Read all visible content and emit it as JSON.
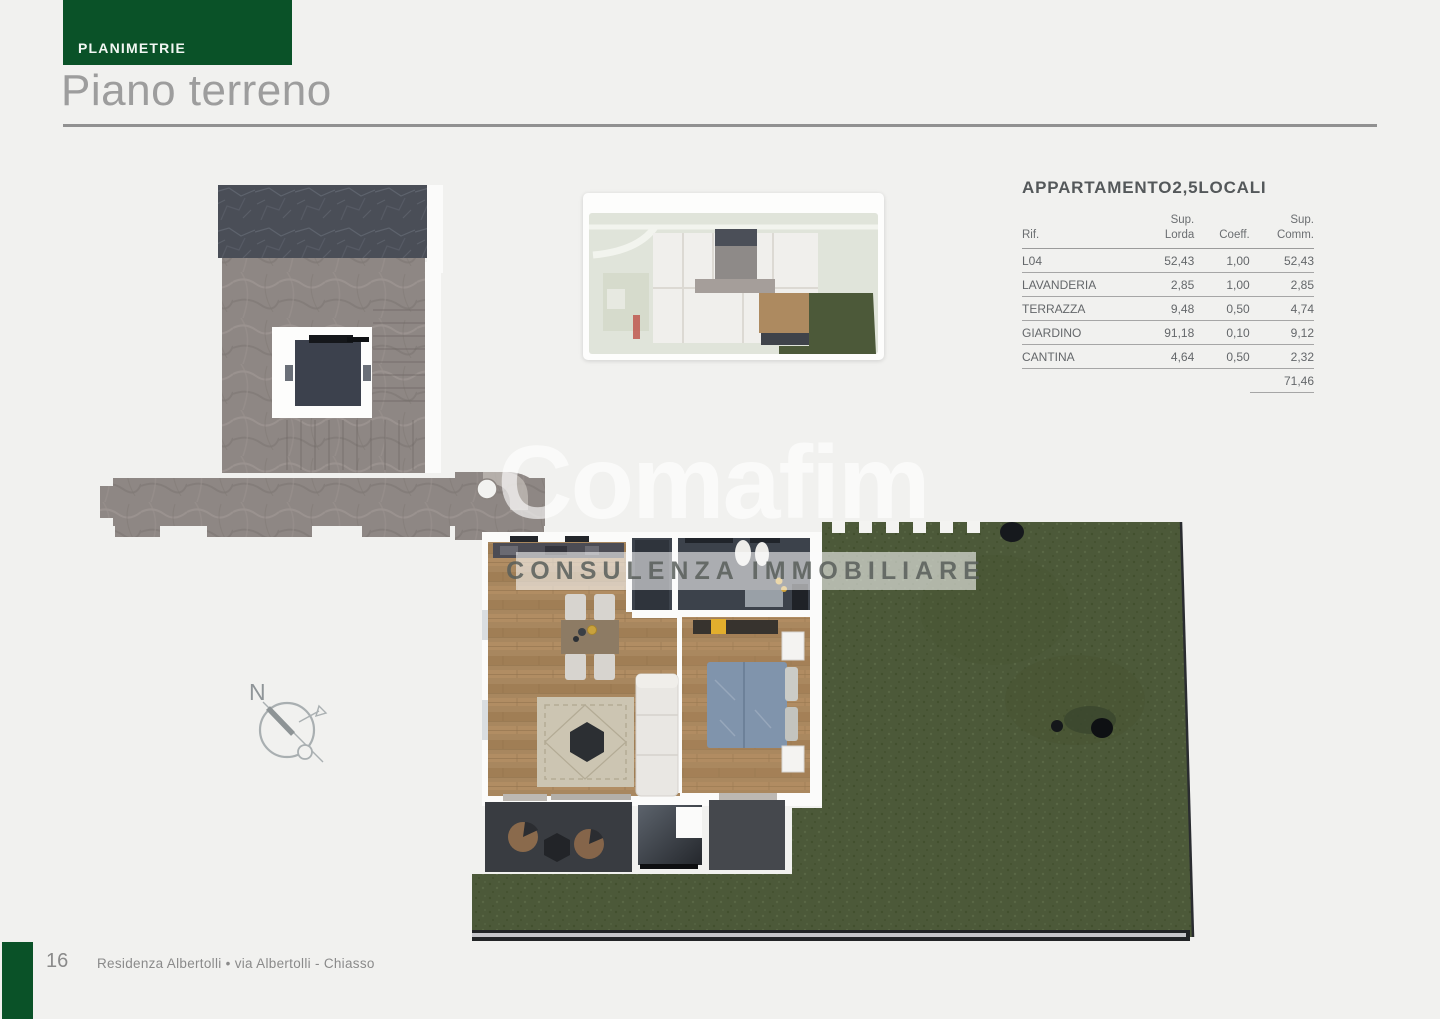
{
  "header": {
    "tag": "PLANIMETRIE",
    "title": "Piano terreno"
  },
  "apartment_panel": {
    "title": "APPARTAMENTO2,5LOCALI",
    "columns": [
      {
        "label": "Rif."
      },
      {
        "label": "Sup.\nLorda"
      },
      {
        "label": "Coeff."
      },
      {
        "label": "Sup.\nComm."
      }
    ],
    "rows": [
      {
        "rif": "L04",
        "lorda": "52,43",
        "coeff": "1,00",
        "comm": "52,43"
      },
      {
        "rif": "LAVANDERIA",
        "lorda": "2,85",
        "coeff": "1,00",
        "comm": "2,85"
      },
      {
        "rif": "TERRAZZA",
        "lorda": "9,48",
        "coeff": "0,50",
        "comm": "4,74"
      },
      {
        "rif": "GIARDINO",
        "lorda": "91,18",
        "coeff": "0,10",
        "comm": "9,12"
      },
      {
        "rif": "CANTINA",
        "lorda": "4,64",
        "coeff": "0,50",
        "comm": "2,32"
      }
    ],
    "total": "71,46"
  },
  "watermark": {
    "brand": "Comafim",
    "tagline": "CONSULENZA IMMOBILIARE"
  },
  "compass": {
    "north": "N"
  },
  "footer": {
    "page_number": "16",
    "project": "Residenza Albertolli • via Albertolli - Chiasso"
  },
  "colors": {
    "accent_green": "#0a5228",
    "garden_green": "#4c5939",
    "slate": "#4a4e57",
    "wood": "#a8875f",
    "stone": "#8e8784"
  }
}
